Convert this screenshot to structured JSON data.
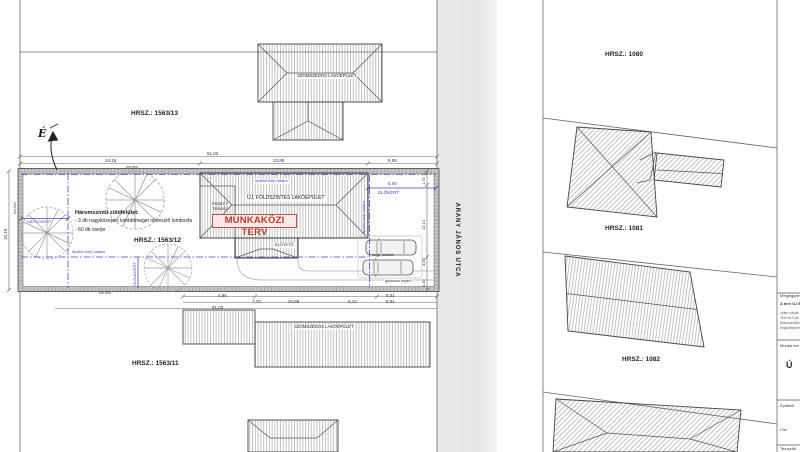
{
  "site": {
    "street_name": "ARANY JÁNOS UTCA",
    "north_label": "É",
    "stamp": "MUNKAKÖZI TERV",
    "parcels": {
      "p1563_13": "HRSZ.: 1563/13",
      "p1563_12": "HRSZ.: 1563/12",
      "p1563_11": "HRSZ.: 1563/11",
      "p1080": "HRSZ.: 1080",
      "p1081": "HRSZ.: 1081",
      "p1082": "HRSZ.: 1082"
    },
    "buildings": {
      "new_main": "ÚJ, FÖLDSZINTES LAKÓÉPÜLET",
      "neighbor_top": "SZOMSZÉDOS LAKÓÉPÜLET",
      "neighbor_bottom": "SZOMSZÉDOS LAKÓÉPÜLET",
      "terrace_line1": "FEDETT",
      "terrace_line2": "TERASZ",
      "canopy": "ELŐTETŐ"
    },
    "zones": {
      "front_yard": "ELŐKERT",
      "back_yard": "HÁTSÓKERT",
      "side_yard": "OLDALKERT",
      "building_zone_line": "építési hely határa",
      "fence": "kerítés",
      "parking": "szgk. beállók",
      "car_entry": "gépkocsi bejáró"
    },
    "green_notes": {
      "title": "Háromszintű zöldfelület:",
      "item1": "- 3 db nagyközepes lombtömeget növesztő lombosfa",
      "item2": "- 60 db cserje"
    },
    "dimensions": {
      "top_total": "51,03",
      "top_seg1": "24,15",
      "top_seg2": "23,88",
      "top_seg3": "8,08",
      "bottom_seg1": "4,96",
      "bottom_seg2": "7,70",
      "bottom_seg3": "9,10",
      "bottom_seg4a": "8,01",
      "bottom_seg4b": "8,01",
      "bottom_sub": "20,88",
      "bottom_total": "51,03",
      "left_side": "15,10",
      "right_seg1": "1,70",
      "right_seg2": "13,14",
      "right_seg3": "4,55",
      "right_seg4": "1,40",
      "front_depth": "6,50"
    },
    "titleblock": {
      "note_header": "Megjegyzés",
      "note_bold": "A terv ÚJ É",
      "note_l1": "Jelen vázlat",
      "note_l2": "Terv és Dok",
      "note_l3": "dokumentáci",
      "note_l4": "engedélyezé",
      "work_label": "Munka me",
      "work_big": "Ú",
      "client_label": "Építtető",
      "address_label": "Cím",
      "designers_label": "Tervezők"
    },
    "colors": {
      "annotation_blue": "#4646c0",
      "stamp_red": "#c0392b",
      "street_gray": "#e6e6e6",
      "hatch_gray": "#909090"
    }
  }
}
